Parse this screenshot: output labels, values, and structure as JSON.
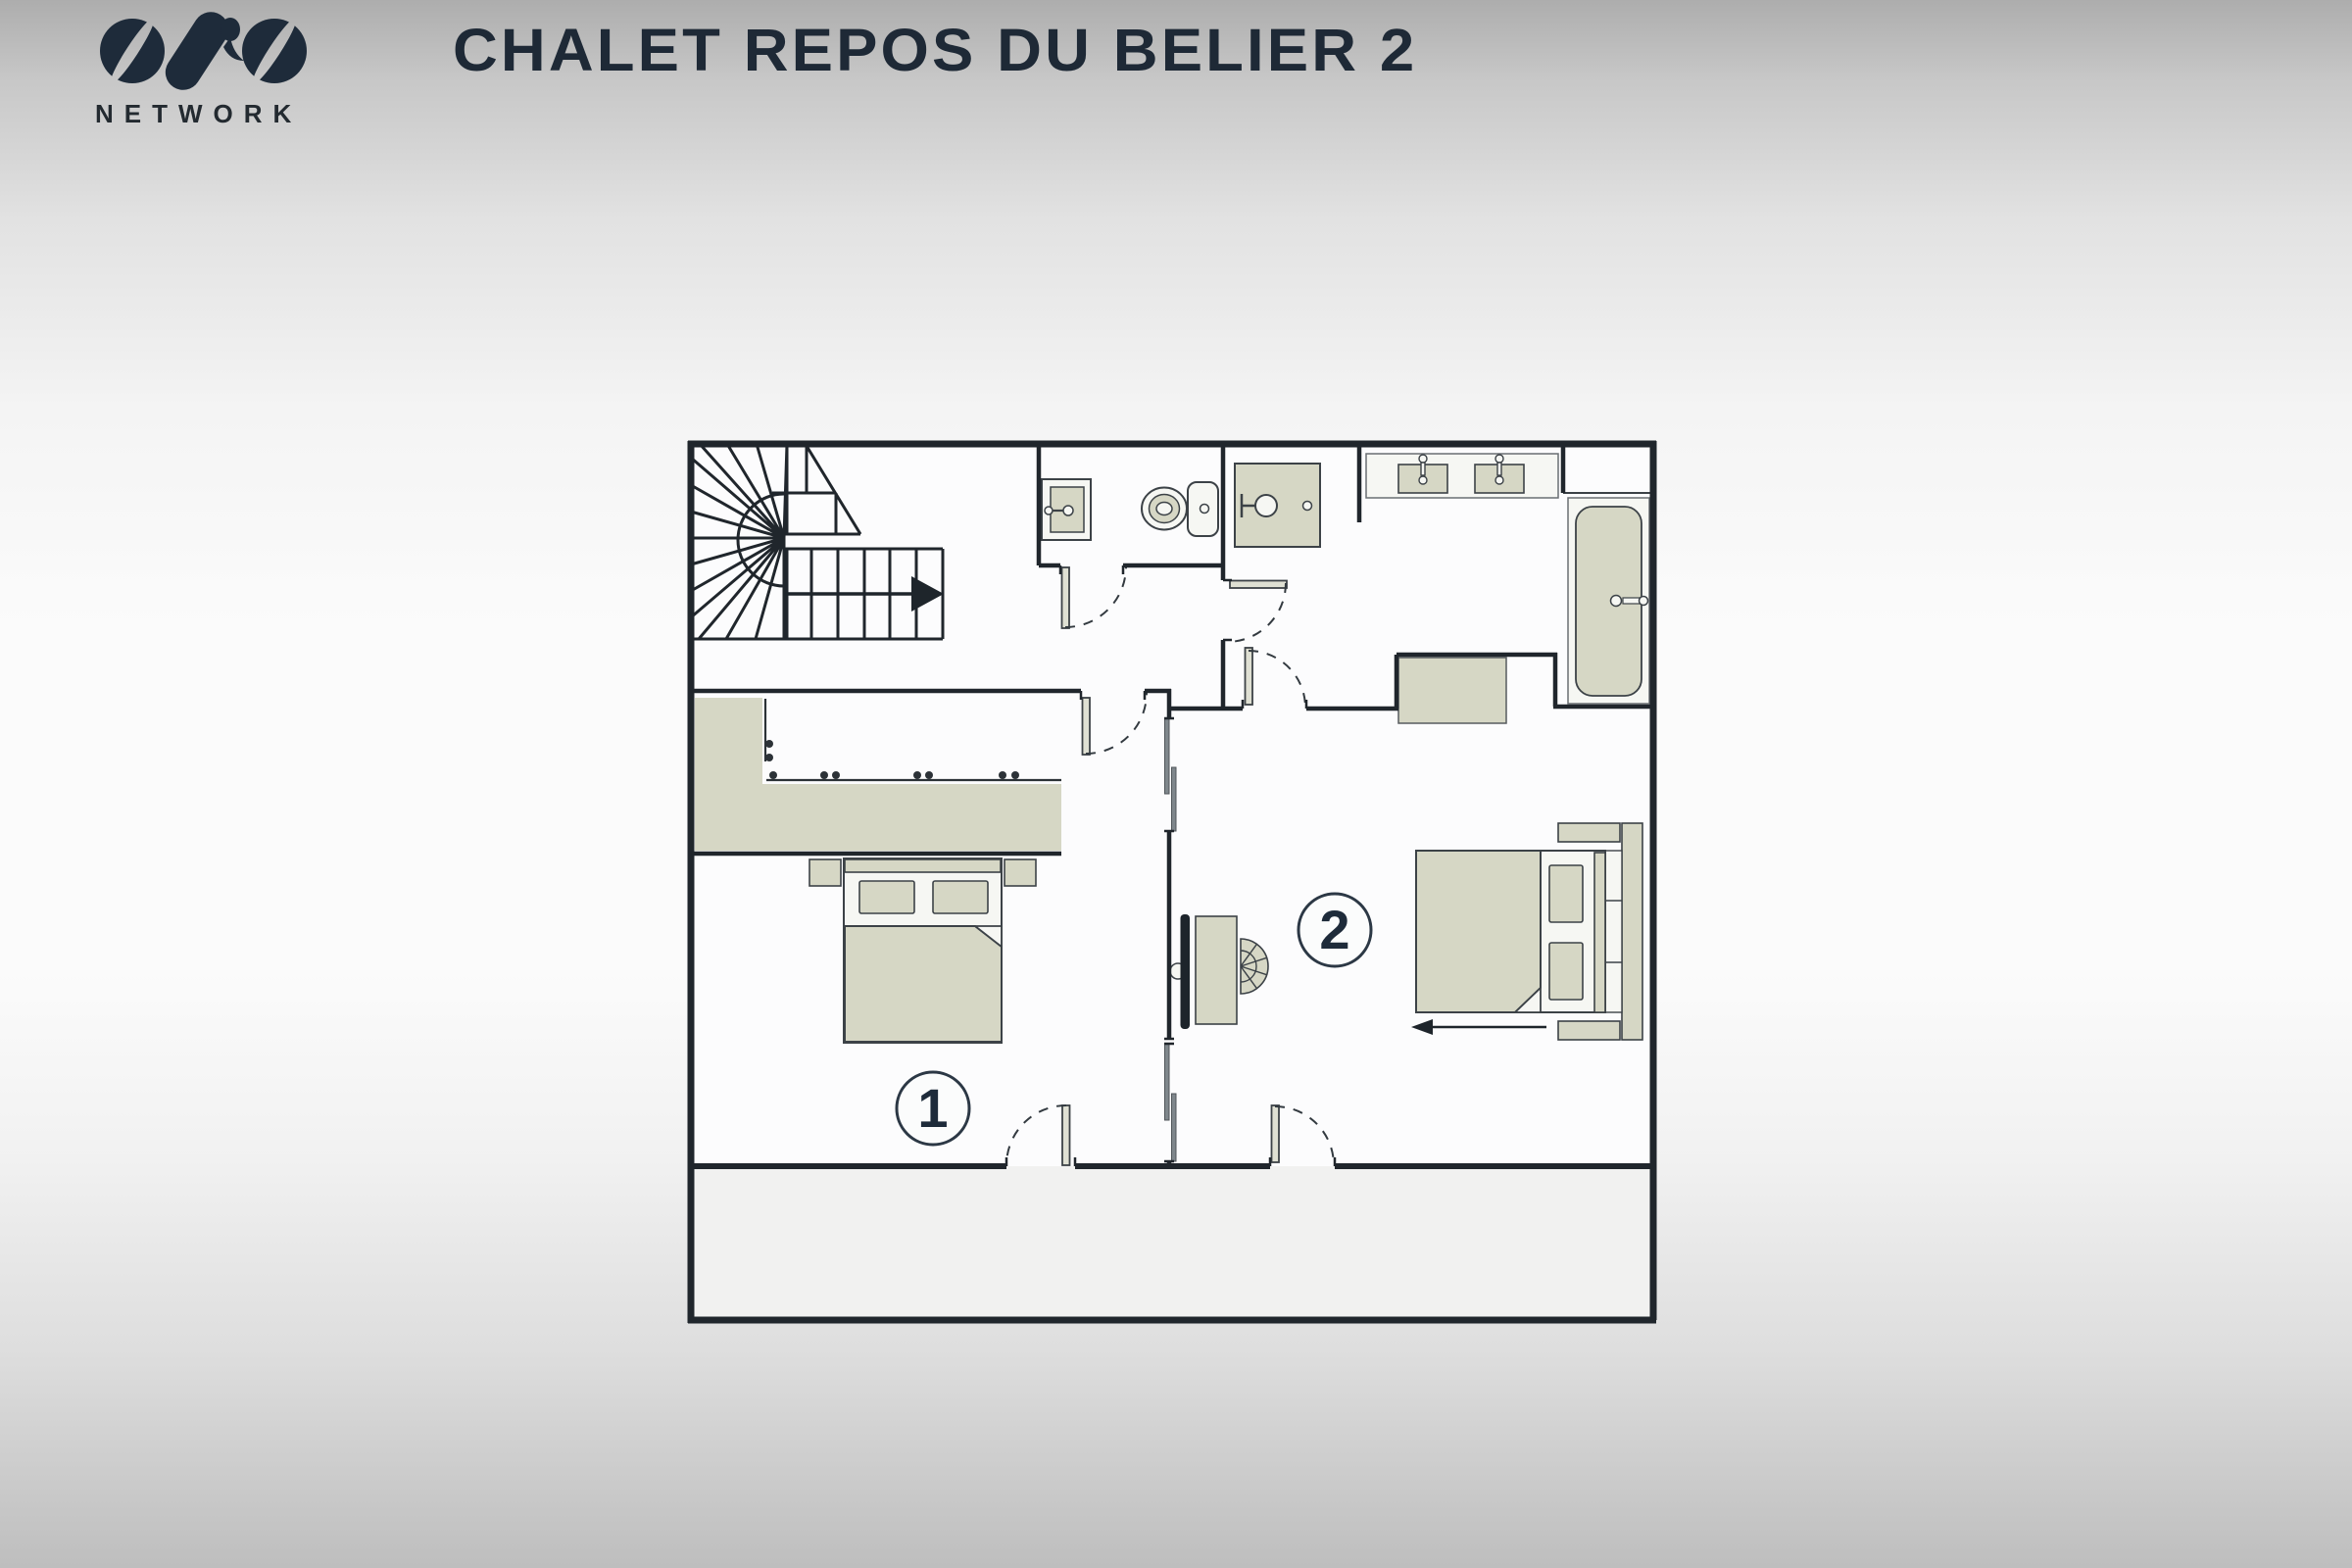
{
  "header": {
    "title": "CHALET REPOS DU BELIER 2",
    "logo": {
      "brand": "OVO",
      "network_label": "NETWORK"
    }
  },
  "floorplan": {
    "badges": {
      "bedroom1": {
        "label": "1"
      },
      "bedroom2": {
        "label": "2"
      }
    },
    "icons": [
      "staircase-icon",
      "stair-direction-arrow-icon",
      "wardrobe-rail-icon",
      "toilet-icon",
      "hand-basin-icon",
      "shower-icon",
      "double-vanity-icon",
      "bathtub-icon",
      "bed-icon",
      "tv-icon",
      "desk-icon",
      "chair-icon",
      "chest-icon",
      "door-swing-icon",
      "sliding-door-icon",
      "bed-pullout-arrow-icon"
    ],
    "colors": {
      "wall": "#20262c",
      "furniture_fill": "#d6d7c5",
      "door_leaf": "#dfe0d3",
      "fixture_white": "#f6f7f3",
      "floor": "#fcfcfd",
      "balcony_floor": "#f1f1f0",
      "accent_navy": "#1e2b3a",
      "slider_gray": "#7f878c"
    }
  }
}
